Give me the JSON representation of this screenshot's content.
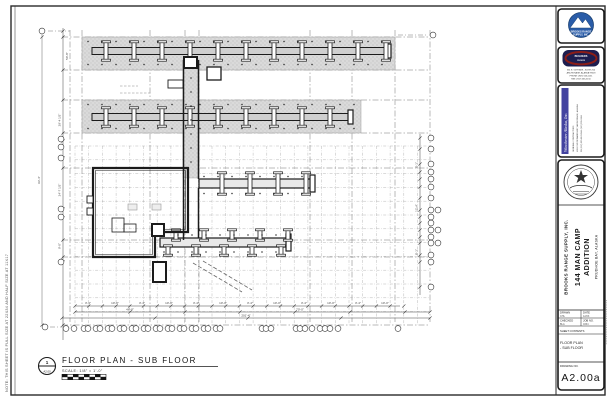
{
  "sheet": {
    "side_note": "NOTE: THIS SHEET IS FULL SIZE AT 22X34 AND HALF SIZE AT 11X17"
  },
  "title_area": {
    "marker_number": "1",
    "marker_sheet": "A2.00",
    "title": "FLOOR PLAN - SUB FLOOR",
    "scale": "SCALE:  1/8\" = 1'-0\""
  },
  "title_block": {
    "logo1": {
      "line1": "BROOKS RANGE",
      "line2": "SUPPLY, INC."
    },
    "logo2": {
      "line1": "BUILDERS",
      "line2": "CHOICE",
      "address": [
        "361 E. 56TH AVE., SUITE 200",
        "ANCHORAGE, ALASKA 99518",
        "PHONE: (907) 563-5151",
        "FAX: (907) 563-5150"
      ]
    },
    "firm": {
      "name": "Winchester Alaska, Inc.",
      "info": [
        "GENERAL CONTRACTORS",
        "4001 OLD SEWARD HWY, ANCHORAGE, ALASKA",
        "PH (907) 555-0123   FAX (907) 555-0124"
      ]
    },
    "company": "BROOKS RANGE SUPPLY, INC.",
    "project_line1": "144 MAN CAMP",
    "project_line2": "ADDITION",
    "location": "PRUDHOE BAY, ALASKA",
    "table": {
      "drawn_label": "DRAWN",
      "drawn": "CHL",
      "date_label": "DATE",
      "date": "12/03",
      "checked_label": "CHECKED",
      "checked": "BLA",
      "job_label": "JOB NO.",
      "job": "0334",
      "contents_label": "SHEET CONTENTS"
    },
    "contents_line1": "FLOOR PLAN",
    "contents_line2": "- SUB FLOOR",
    "drawing_no_label": "DRAWING NO.",
    "drawing_no": "A2.00a"
  },
  "plan": {
    "colors": {
      "line": "#1b1b1b",
      "gray": "#8a8a8a",
      "stipple_base": "#dadada"
    },
    "grid_minor_x": {
      "start": 75,
      "end": 430,
      "step": 13.7,
      "y1": 146,
      "y2": 325
    },
    "grid_minor_y": {
      "start": 146,
      "end": 325,
      "step": 13.8,
      "x1": 75,
      "x2": 430
    },
    "grid_major_x": {
      "xs": [
        70,
        82,
        150,
        185,
        199,
        310,
        352,
        395,
        430
      ],
      "y1": 30,
      "y2": 322
    },
    "grid_major_y": {
      "ys": [
        37,
        70,
        100,
        133,
        168,
        240,
        257,
        325
      ],
      "x1": 62,
      "x2": 430
    },
    "dot_rows": [
      {
        "y": 41.5,
        "x1": 88,
        "x2": 392,
        "step": 14
      },
      {
        "y": 64.5,
        "x1": 88,
        "x2": 392,
        "step": 14
      },
      {
        "y": 104.5,
        "x1": 88,
        "x2": 358,
        "step": 14
      },
      {
        "y": 128.5,
        "x1": 88,
        "x2": 358,
        "step": 14
      },
      {
        "y": 176.5,
        "x1": 204,
        "x2": 308,
        "step": 14
      },
      {
        "y": 193.5,
        "x1": 204,
        "x2": 308,
        "step": 14
      },
      {
        "y": 235.0,
        "x1": 164,
        "x2": 286,
        "step": 14
      },
      {
        "y": 252.0,
        "x1": 164,
        "x2": 286,
        "step": 14
      }
    ],
    "dot_cols": [
      {
        "x": 191,
        "y1": 64,
        "y2": 172,
        "step": 14
      }
    ],
    "beams": [
      {
        "xs": [
          106,
          134,
          162,
          190,
          218,
          246,
          274,
          302,
          330,
          358,
          386
        ],
        "top": 42,
        "h": 18
      },
      {
        "xs": [
          106,
          134,
          162,
          190,
          218,
          246,
          274,
          302,
          330
        ],
        "top": 108,
        "h": 18
      },
      {
        "xs": [
          222,
          250,
          278,
          306
        ],
        "top": 173,
        "h": 21
      },
      {
        "xs": [
          176,
          204,
          232,
          260,
          288
        ],
        "top": 230,
        "h": 10
      },
      {
        "xs": [
          168,
          196,
          224,
          252,
          281
        ],
        "top": 246,
        "h": 9
      }
    ],
    "bubbles": [
      [
        42,
        31
      ],
      [
        433,
        35
      ],
      [
        61,
        139
      ],
      [
        61,
        147
      ],
      [
        61,
        158
      ],
      [
        61,
        209
      ],
      [
        61,
        217
      ],
      [
        61,
        262
      ],
      [
        45,
        327
      ],
      [
        431,
        138
      ],
      [
        431,
        149
      ],
      [
        431,
        164
      ],
      [
        431,
        172
      ],
      [
        431,
        179
      ],
      [
        431,
        187
      ],
      [
        431,
        198
      ],
      [
        431,
        210
      ],
      [
        438,
        210
      ],
      [
        431,
        217
      ],
      [
        431,
        223
      ],
      [
        431,
        230
      ],
      [
        438,
        230
      ],
      [
        431,
        237
      ],
      [
        431,
        243
      ],
      [
        438,
        243
      ],
      [
        431,
        255
      ],
      [
        431,
        262
      ],
      [
        431,
        287
      ],
      [
        66,
        328.5
      ],
      [
        74,
        328.5
      ],
      [
        84,
        328.5
      ],
      [
        88,
        328.5
      ],
      [
        96,
        328.5
      ],
      [
        100,
        328.5
      ],
      [
        108,
        328.5
      ],
      [
        112,
        328.5
      ],
      [
        120,
        328.5
      ],
      [
        124,
        328.5
      ],
      [
        132,
        328.5
      ],
      [
        136,
        328.5
      ],
      [
        144,
        328.5
      ],
      [
        148,
        328.5
      ],
      [
        156,
        328.5
      ],
      [
        160,
        328.5
      ],
      [
        168,
        328.5
      ],
      [
        172,
        328.5
      ],
      [
        180,
        328.5
      ],
      [
        184,
        328.5
      ],
      [
        192,
        328.5
      ],
      [
        196,
        328.5
      ],
      [
        204,
        328.5
      ],
      [
        208,
        328.5
      ],
      [
        216,
        328.5
      ],
      [
        220,
        328.5
      ],
      [
        262,
        328.5
      ],
      [
        266,
        328.5
      ],
      [
        271,
        328.5
      ],
      [
        296,
        328.5
      ],
      [
        300,
        328.5
      ],
      [
        305,
        328.5
      ],
      [
        312,
        328.5
      ],
      [
        320,
        328.5
      ],
      [
        325,
        328.5
      ],
      [
        330,
        328.5
      ],
      [
        338,
        328.5
      ],
      [
        398,
        328.5
      ]
    ],
    "tick_rows": [
      {
        "y": 306,
        "xs": [
          75,
          88.7,
          102.4,
          116.1,
          129.8,
          143.5,
          157.2,
          170.9,
          184.6,
          198.3,
          212,
          225.7,
          239.4,
          253.1,
          266.8,
          280.5,
          294.2,
          307.9,
          321.6,
          335.3,
          349,
          362.7,
          376.4,
          390.1,
          403.8
        ]
      },
      {
        "y": 312,
        "xs": [
          75,
          130,
          185,
          240,
          295,
          350,
          405,
          430
        ]
      },
      {
        "y": 318,
        "xs": [
          62,
          155,
          248,
          341,
          430
        ]
      }
    ],
    "tick_cols": [
      {
        "x": 63,
        "ys": [
          31,
          37,
          70,
          100,
          133,
          141,
          158,
          168,
          209,
          218,
          240,
          257,
          262,
          325
        ]
      },
      {
        "x": 42,
        "ys": [
          37,
          325
        ]
      },
      {
        "x": 420,
        "ys": [
          138,
          149,
          164,
          172,
          179,
          187,
          198,
          210,
          217,
          223,
          230,
          237,
          243,
          255,
          262,
          287
        ]
      }
    ],
    "labels_bottom": [
      {
        "x": 88,
        "y": 304.2,
        "t": "3'-4\""
      },
      {
        "x": 115,
        "y": 304.2,
        "t": "10'-0\""
      },
      {
        "x": 142,
        "y": 304.2,
        "t": "3'-4\""
      },
      {
        "x": 169,
        "y": 304.2,
        "t": "10'-0\""
      },
      {
        "x": 196,
        "y": 304.2,
        "t": "3'-4\""
      },
      {
        "x": 223,
        "y": 304.2,
        "t": "10'-0\""
      },
      {
        "x": 250,
        "y": 304.2,
        "t": "3'-4\""
      },
      {
        "x": 277,
        "y": 304.2,
        "t": "10'-0\""
      },
      {
        "x": 304,
        "y": 304.2,
        "t": "3'-4\""
      },
      {
        "x": 331,
        "y": 304.2,
        "t": "10'-0\""
      },
      {
        "x": 358,
        "y": 304.2,
        "t": "3'-4\""
      },
      {
        "x": 385,
        "y": 304.2,
        "t": "10'-0\""
      },
      {
        "x": 130,
        "y": 310.4,
        "t": "46'-8\""
      },
      {
        "x": 300,
        "y": 310.4,
        "t": "70'-0\""
      },
      {
        "x": 246,
        "y": 316.4,
        "t": "201'-4\""
      }
    ],
    "labels_left": [
      {
        "x": 60.5,
        "y": 120,
        "t": "29'-4 1/2\""
      },
      {
        "x": 60.5,
        "y": 190,
        "t": "24'-7 1/2\""
      },
      {
        "x": 60.5,
        "y": 246,
        "t": "9'-0\""
      },
      {
        "x": 40,
        "y": 180,
        "t": "93'-4\""
      },
      {
        "x": 68,
        "y": 56,
        "t": "50'-8\""
      }
    ],
    "labels_right": [
      {
        "x": 417.5,
        "y": 165,
        "t": "8'-1\""
      },
      {
        "x": 417.5,
        "y": 208,
        "t": "12'-4\""
      },
      {
        "x": 417.5,
        "y": 252,
        "t": "8'-1\""
      }
    ],
    "scale_bar": {
      "x": 62,
      "y": 374.3,
      "w": 44,
      "h": 5.4,
      "top_blacks": [
        62,
        73,
        84,
        95
      ],
      "bot_blacks": [
        67.5,
        78.5,
        89.5,
        100.5
      ],
      "seg_w": 5.5
    }
  }
}
